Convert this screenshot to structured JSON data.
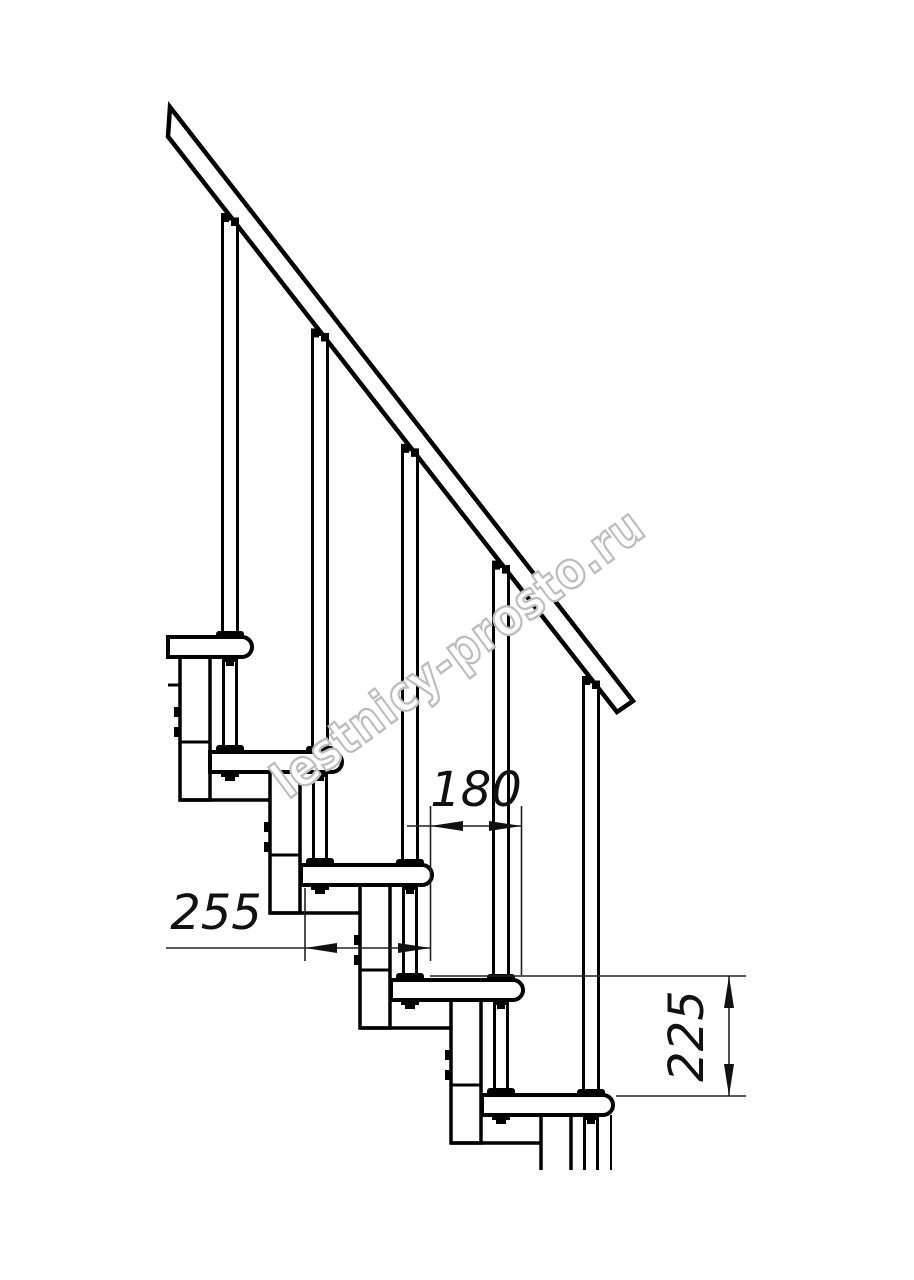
{
  "drawing": {
    "watermark": {
      "text": "lestnicy-prosto.ru",
      "color": "#bdbdbd"
    },
    "colors": {
      "line": "#000000",
      "background": "#ffffff",
      "dimension_text": "#111111"
    },
    "dimensions": {
      "run_horizontal": {
        "value": "180"
      },
      "tread_depth": {
        "value": "255"
      },
      "step_rise": {
        "value": "225"
      }
    },
    "counts": {
      "treads": 5,
      "balusters": 5
    }
  }
}
